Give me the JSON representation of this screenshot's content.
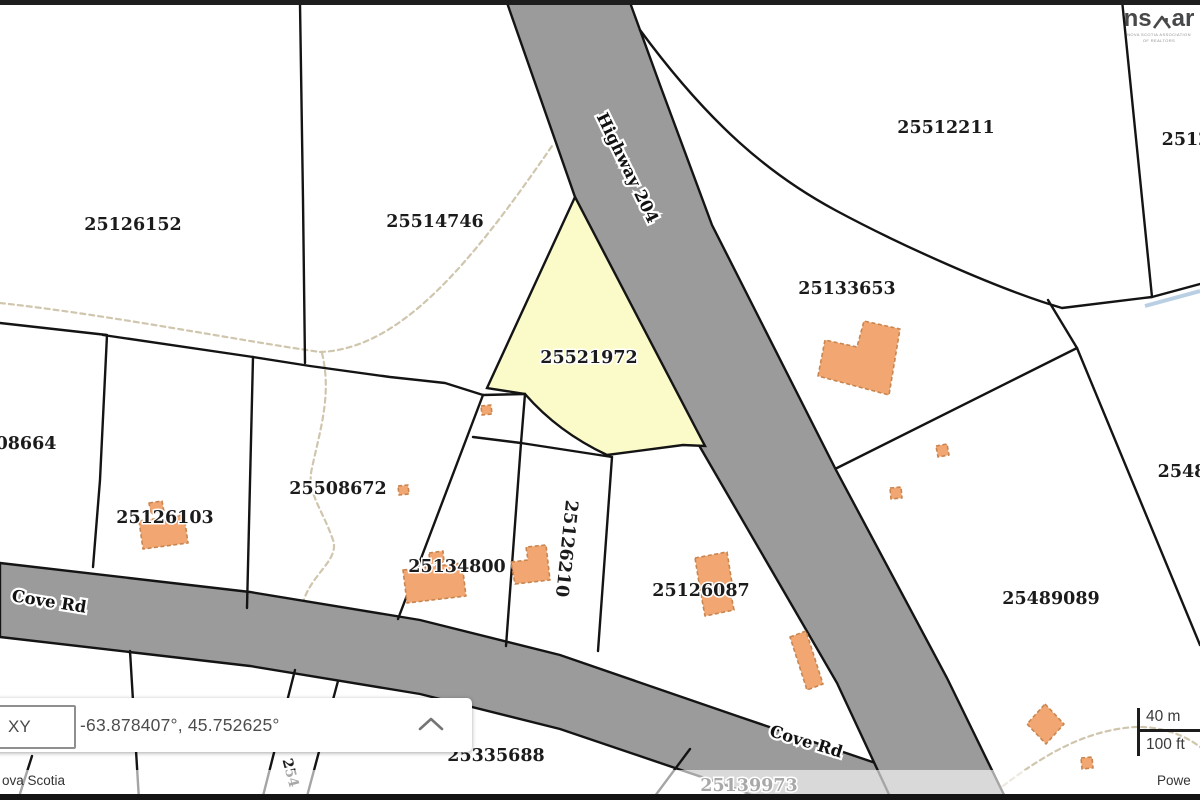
{
  "logo": {
    "text_left": "ns",
    "text_right": "ar",
    "tagline_line1": "NOVA SCOTIA ASSOCIATION",
    "tagline_line2": "OF REALTORS"
  },
  "coordinate_panel": {
    "selector_label": "XY",
    "coordinates": "-63.878407°, 45.752625°"
  },
  "scale_bar": {
    "metric": "40 m",
    "imperial": "100 ft"
  },
  "attribution": {
    "left_text": "ova Scotia",
    "right_text": "Powe"
  },
  "colors": {
    "road_fill": "#9b9b9b",
    "highlight_fill": "#fbfbc9",
    "highlight_label": "#8b8b45",
    "faded_label": "#ababab",
    "building_fill": "#f2a772",
    "building_border": "#c9854f",
    "label_color": "#1b1b1b"
  },
  "map": {
    "highlighted_parcel": "25521972",
    "parcels": [
      {
        "label": "25126152"
      },
      {
        "label": "25514746"
      },
      {
        "label": "25512211"
      },
      {
        "label": "2512"
      },
      {
        "label": "25133653"
      },
      {
        "label": "25521972"
      },
      {
        "label": "08664"
      },
      {
        "label": "25508672"
      },
      {
        "label": "25126103"
      },
      {
        "label": "25134800"
      },
      {
        "label": "25126210"
      },
      {
        "label": "25126087"
      },
      {
        "label": "25489089"
      },
      {
        "label": "2548"
      },
      {
        "label": "25335688"
      },
      {
        "label": "25139973"
      },
      {
        "label": "254"
      }
    ],
    "road_labels": [
      {
        "name": "Highway 204"
      },
      {
        "name": "Cove Rd"
      },
      {
        "name": "Cove Rd"
      }
    ]
  }
}
